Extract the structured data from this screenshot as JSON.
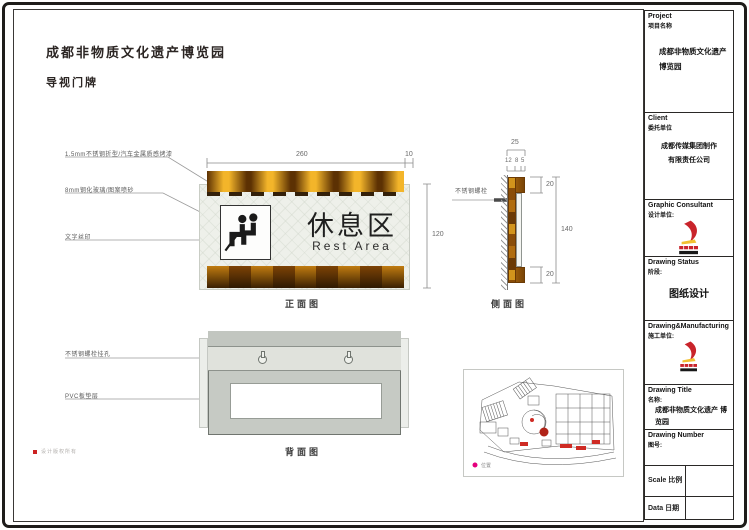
{
  "page": {
    "title": "成都非物质文化遗产博览园",
    "subtitle": "导视门牌",
    "footnote": "设计版权所有"
  },
  "front": {
    "caption": "正面图",
    "callout_steel": "1.5mm不锈钢折型/汽车金属质感烤漆",
    "callout_glass": "8mm钢化玻璃/图案喷砂",
    "callout_print": "文字丝印",
    "sign_cn": "休息区",
    "sign_en": "Rest Area",
    "dim_width": "260",
    "dim_edge": "10",
    "dim_height": "120"
  },
  "side": {
    "caption": "侧面图",
    "callout_bolt": "不锈钢螺栓",
    "dim_total": "25",
    "dim_a": "12",
    "dim_b": "8",
    "dim_c": "5",
    "dim_top": "20",
    "dim_mid": "140",
    "dim_bottom": "20"
  },
  "back": {
    "caption": "背面图",
    "callout_hole": "不锈钢螺栓挂孔",
    "callout_pvc": "PVC板垫层"
  },
  "map": {
    "legend": "位置"
  },
  "title_block": {
    "project": {
      "label_en": "Project",
      "label_cn": "项目名称",
      "value": "成都非物质文化遗产 博览园"
    },
    "client": {
      "label_en": "Client",
      "label_cn": "委托单位",
      "value_line1": "成都传媒集团制作",
      "value_line2": "有限责任公司"
    },
    "consultant": {
      "label_en": "Graphic Consultant",
      "label_cn": "设计单位:"
    },
    "status": {
      "label_en": "Drawing Status",
      "label_cn": "阶段:",
      "value": "图纸设计"
    },
    "manufacturing": {
      "label_en": "Drawing&Manufacturing",
      "label_cn": "施工单位:"
    },
    "drawing_title": {
      "label_en": "Drawing Title",
      "label_cn": "名称:",
      "value": "成都非物质文化遗产 博览园"
    },
    "drawing_number": {
      "label_en": "Drawing Number",
      "label_cn": "图号:"
    },
    "scale": {
      "label_en": "Scale",
      "label_cn": "比例",
      "value": ""
    },
    "date": {
      "label_en": "Data",
      "label_cn": "日期",
      "value": ""
    }
  },
  "colors": {
    "accent_gold": "#f3b52a",
    "accent_brown": "#5c3103",
    "logo_red": "#c9242b",
    "logo_yellow": "#f2c030",
    "marker_red": "#cf2b24",
    "legend_magenta": "#e5007d"
  }
}
